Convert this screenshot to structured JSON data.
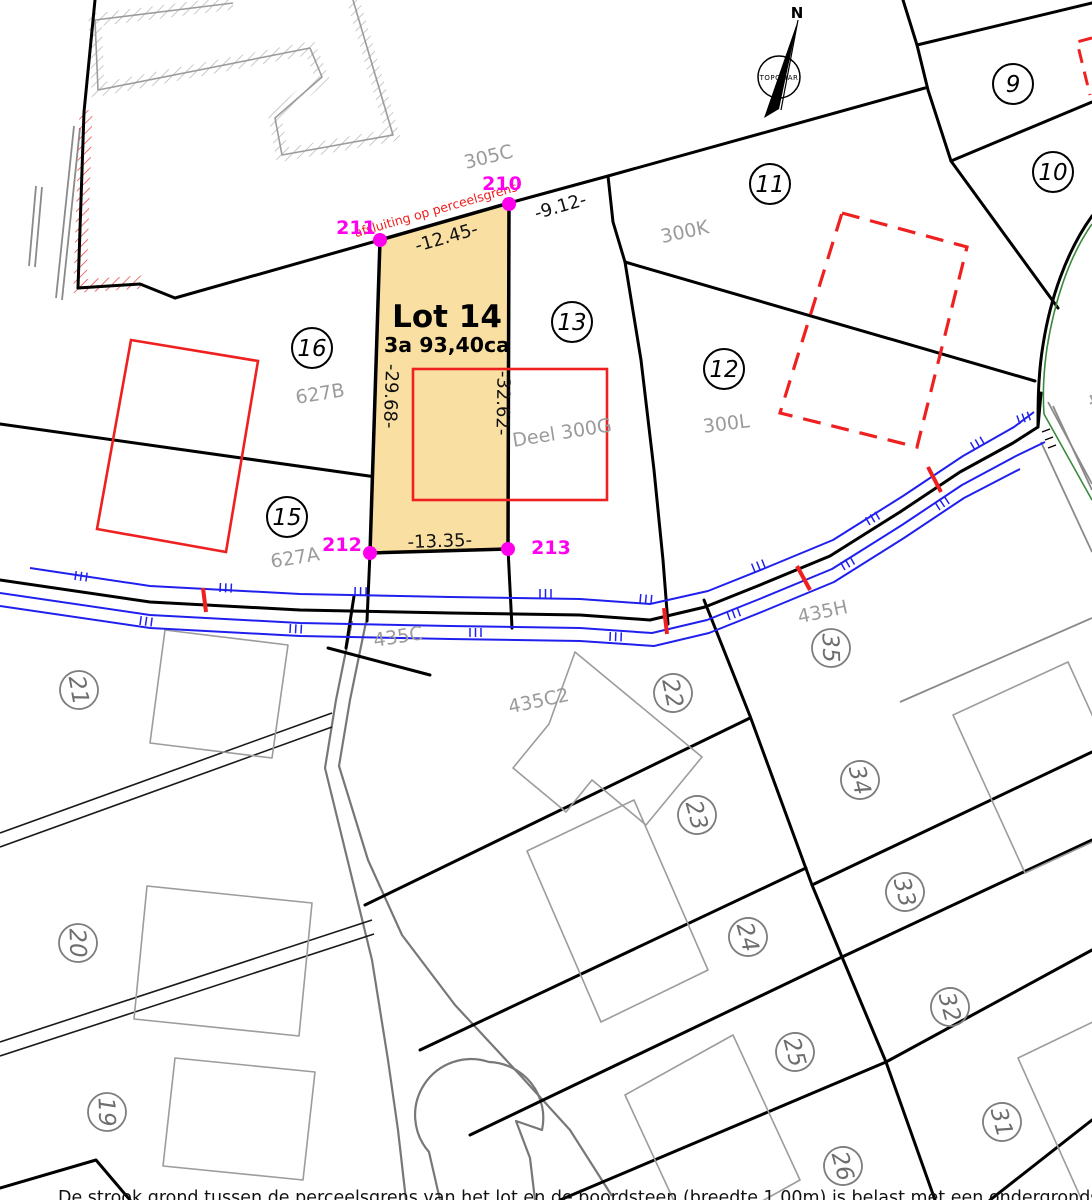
{
  "lot": {
    "name": "Lot 14",
    "area": "3a 93,40ca"
  },
  "points": [
    {
      "id": "210"
    },
    {
      "id": "211"
    },
    {
      "id": "212"
    },
    {
      "id": "213"
    }
  ],
  "dimensions": {
    "top": "-12.45-",
    "ne": "-9.12-",
    "left": "-29.68-",
    "right": "-32.62-",
    "bottom": "-13.35-"
  },
  "notes": {
    "fence_line": "afsluiting op perceelsgrens",
    "deel": "Deel 300G"
  },
  "parcel_labels": [
    {
      "text": "305C"
    },
    {
      "text": "300K"
    },
    {
      "text": "300L"
    },
    {
      "text": "627B"
    },
    {
      "text": "627A"
    },
    {
      "text": "435C"
    },
    {
      "text": "435C2"
    },
    {
      "text": "435H"
    }
  ],
  "parcel_numbers": [
    {
      "n": "9"
    },
    {
      "n": "10"
    },
    {
      "n": "11"
    },
    {
      "n": "12"
    },
    {
      "n": "13"
    },
    {
      "n": "15"
    },
    {
      "n": "16"
    }
  ],
  "parcel_numbers_gray": [
    {
      "n": "19"
    },
    {
      "n": "20"
    },
    {
      "n": "21"
    },
    {
      "n": "22"
    },
    {
      "n": "23"
    },
    {
      "n": "24"
    },
    {
      "n": "25"
    },
    {
      "n": "26"
    },
    {
      "n": "31"
    },
    {
      "n": "32"
    },
    {
      "n": "33"
    },
    {
      "n": "34"
    },
    {
      "n": "35"
    }
  ],
  "compass": {
    "north_label": "N",
    "maker": "TOPOMAR"
  },
  "edge_fragment": "4",
  "footer": "De strook grond tussen de perceelsgrens van het lot en de boordsteen (breedte  1.00m) is belast met een ondergrondse inneming",
  "colors": {
    "lot_fill": "#f9e0a2",
    "survey_point": "#ff00ee",
    "red_overlay": "#ee2020",
    "road_blue": "#2020ee",
    "curve_green": "#3c8a3c",
    "gray_label": "#9b9b9b",
    "boundary_black": "#000000",
    "building_gray": "#9c9c9c"
  }
}
